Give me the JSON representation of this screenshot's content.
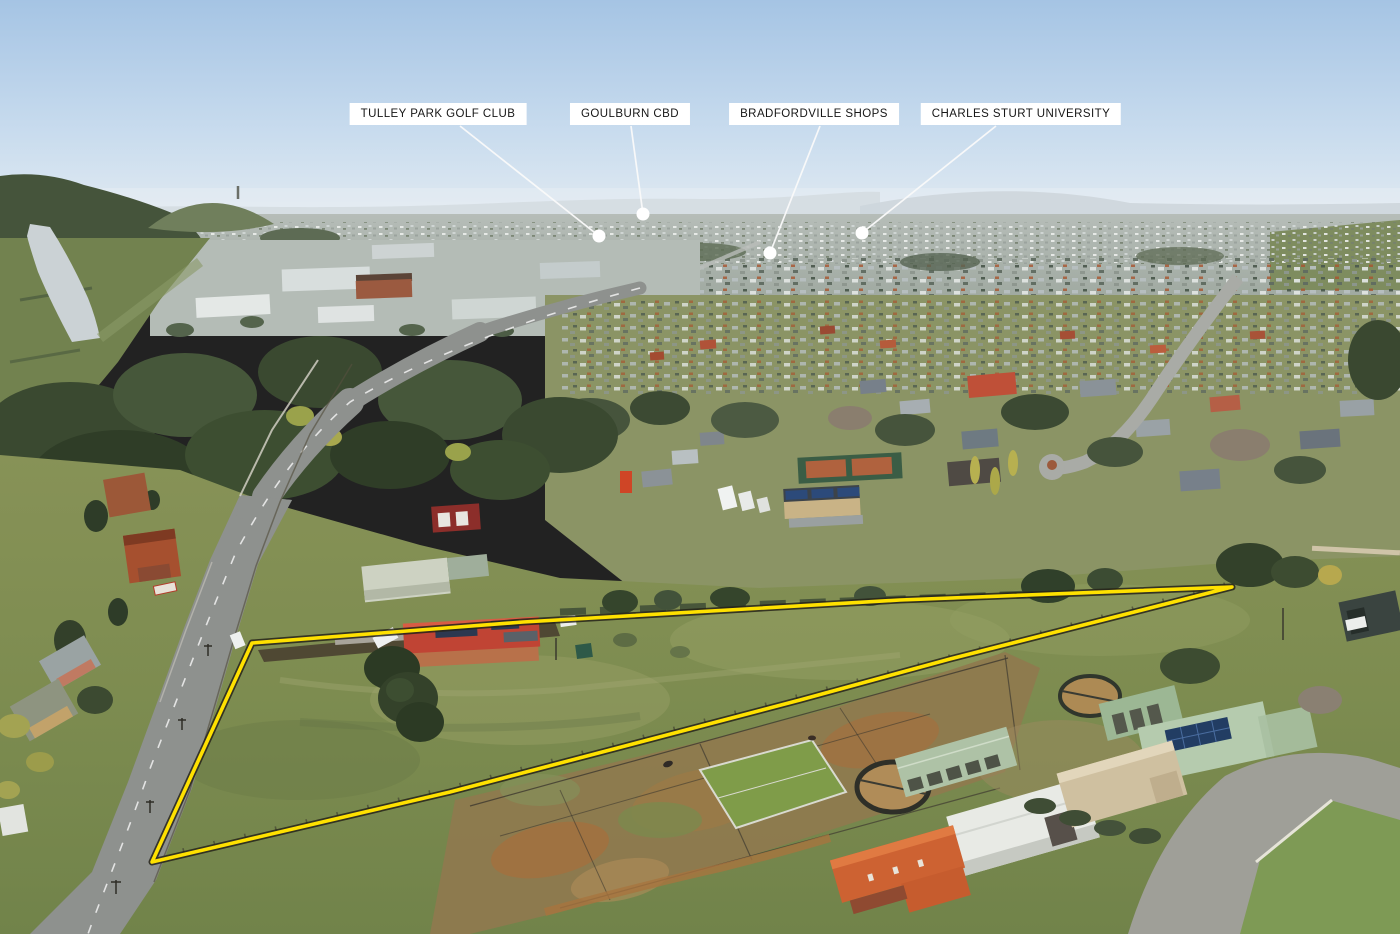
{
  "image": {
    "kind": "aerial-drone-photo",
    "width": 1400,
    "height": 934,
    "description": "Aerial photo of a semi-rural acreage property on the edge of town, boundary outlined in yellow, with four location callouts on the horizon"
  },
  "callouts": [
    {
      "label": "TULLEY PARK GOLF CLUB"
    },
    {
      "label": "GOULBURN CBD"
    },
    {
      "label": "BRADFORDVILLE SHOPS"
    },
    {
      "label": "CHARLES STURT UNIVERSITY"
    }
  ],
  "boundary": {
    "color": "#FFE100",
    "outline_color": "#26231a"
  },
  "palette": {
    "label_background": "#FFFFFF",
    "label_text": "#161616",
    "leader_line": "#FAFAFA",
    "callout_dot": "#FFFFFF",
    "sky_top": "#A5C4E4",
    "sky_horizon": "#E9EFF3",
    "haze_hills": "#C6D0D6",
    "city_band": "#ACB4AE",
    "tree_dark": "#3A4930",
    "grass_field": "#85915A",
    "grass_dark": "#5E7045",
    "dirt_tan": "#A4713F",
    "road_gray": "#8E918E",
    "river_water": "#CBD2D5",
    "main_house_roof": "#C04434"
  }
}
